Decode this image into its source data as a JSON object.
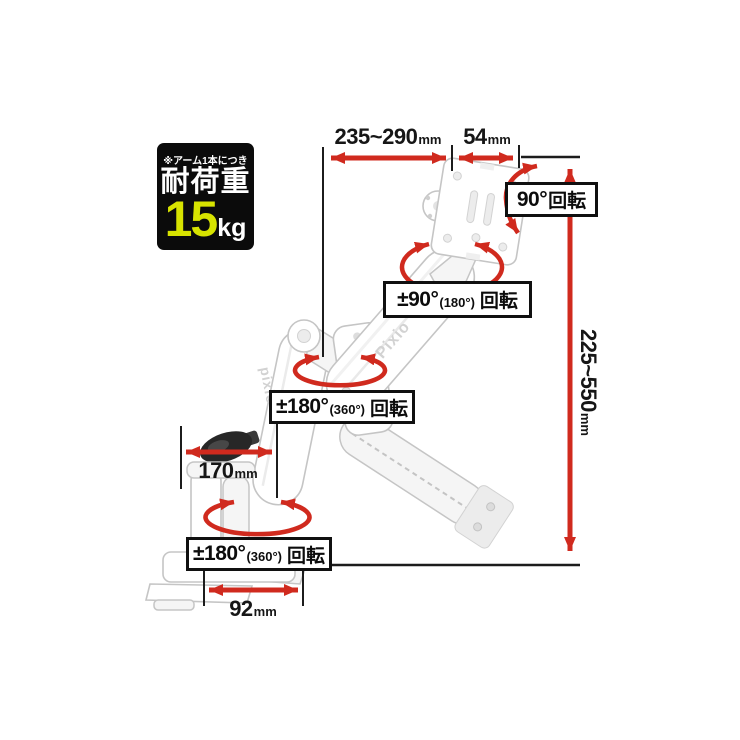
{
  "badge": {
    "note": "※アーム1本につき",
    "title": "耐荷重",
    "value": "15",
    "unit": "kg"
  },
  "dimensions": {
    "arm_upper_reach": {
      "value": "235~290",
      "unit": "mm"
    },
    "head_depth": {
      "value": "54",
      "unit": "mm"
    },
    "height_range": {
      "value": "225~550",
      "unit": "mm"
    },
    "lower_arm_width": {
      "value": "170",
      "unit": "mm"
    },
    "clamp_depth": {
      "value": "92",
      "unit": "mm"
    }
  },
  "callouts": {
    "head_pivot": {
      "main": "90°",
      "suffix": "回転"
    },
    "head_swivel": {
      "main": "±90°",
      "paren": "(180°)",
      "suffix": "回転"
    },
    "elbow_swivel": {
      "main": "±180°",
      "paren": "(360°)",
      "suffix": "回転"
    },
    "base_swivel": {
      "main": "±180°",
      "paren": "(360°)",
      "suffix": "回転"
    }
  },
  "product": {
    "brand_upper_arm": "Pixio",
    "brand_lower_arm": "pixio"
  },
  "colors": {
    "accent_red": "#d02a1e",
    "badge_bg": "#0b0b0b",
    "badge_accent": "#d7e300",
    "ink": "#161616",
    "outline_gray": "#c5c5c5"
  }
}
